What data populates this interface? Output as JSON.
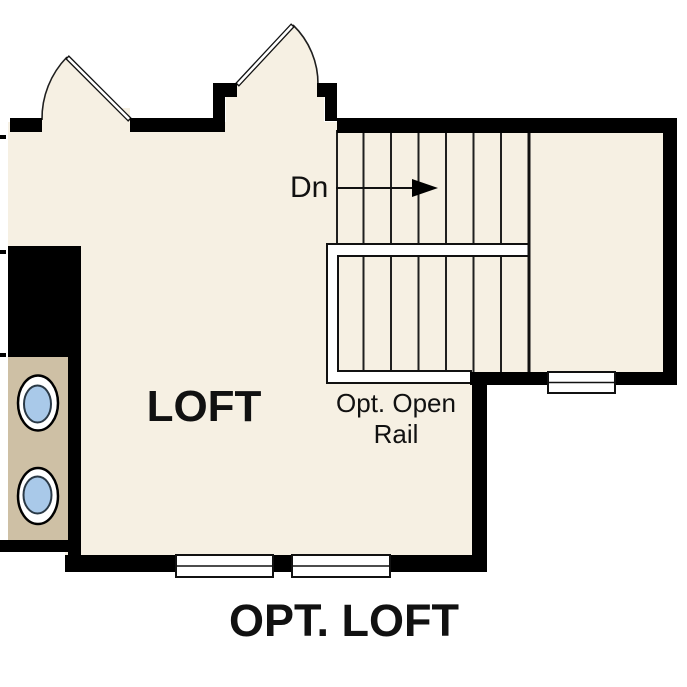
{
  "figure": {
    "kind": "floor-plan",
    "plan_title": "OPT. LOFT",
    "room_label": "LOFT",
    "stair_direction_label": "Dn",
    "rail_note_line1": "Opt. Open",
    "rail_note_line2": "Rail"
  },
  "stairs": {
    "direction_label": "Dn",
    "upper_run_tread_count": 7,
    "lower_run_tread_count": 7
  },
  "fixtures": {
    "door_count": 2,
    "window_count": 3,
    "sink_count": 2
  },
  "colors": {
    "background": "#ffffff",
    "floor": "#f6f0e3",
    "wall": "#000000",
    "line": "#1f1f1f",
    "counter": "#cec0a5",
    "sink_fill": "#a9c9e9",
    "sink_rim": "#2a3946"
  }
}
